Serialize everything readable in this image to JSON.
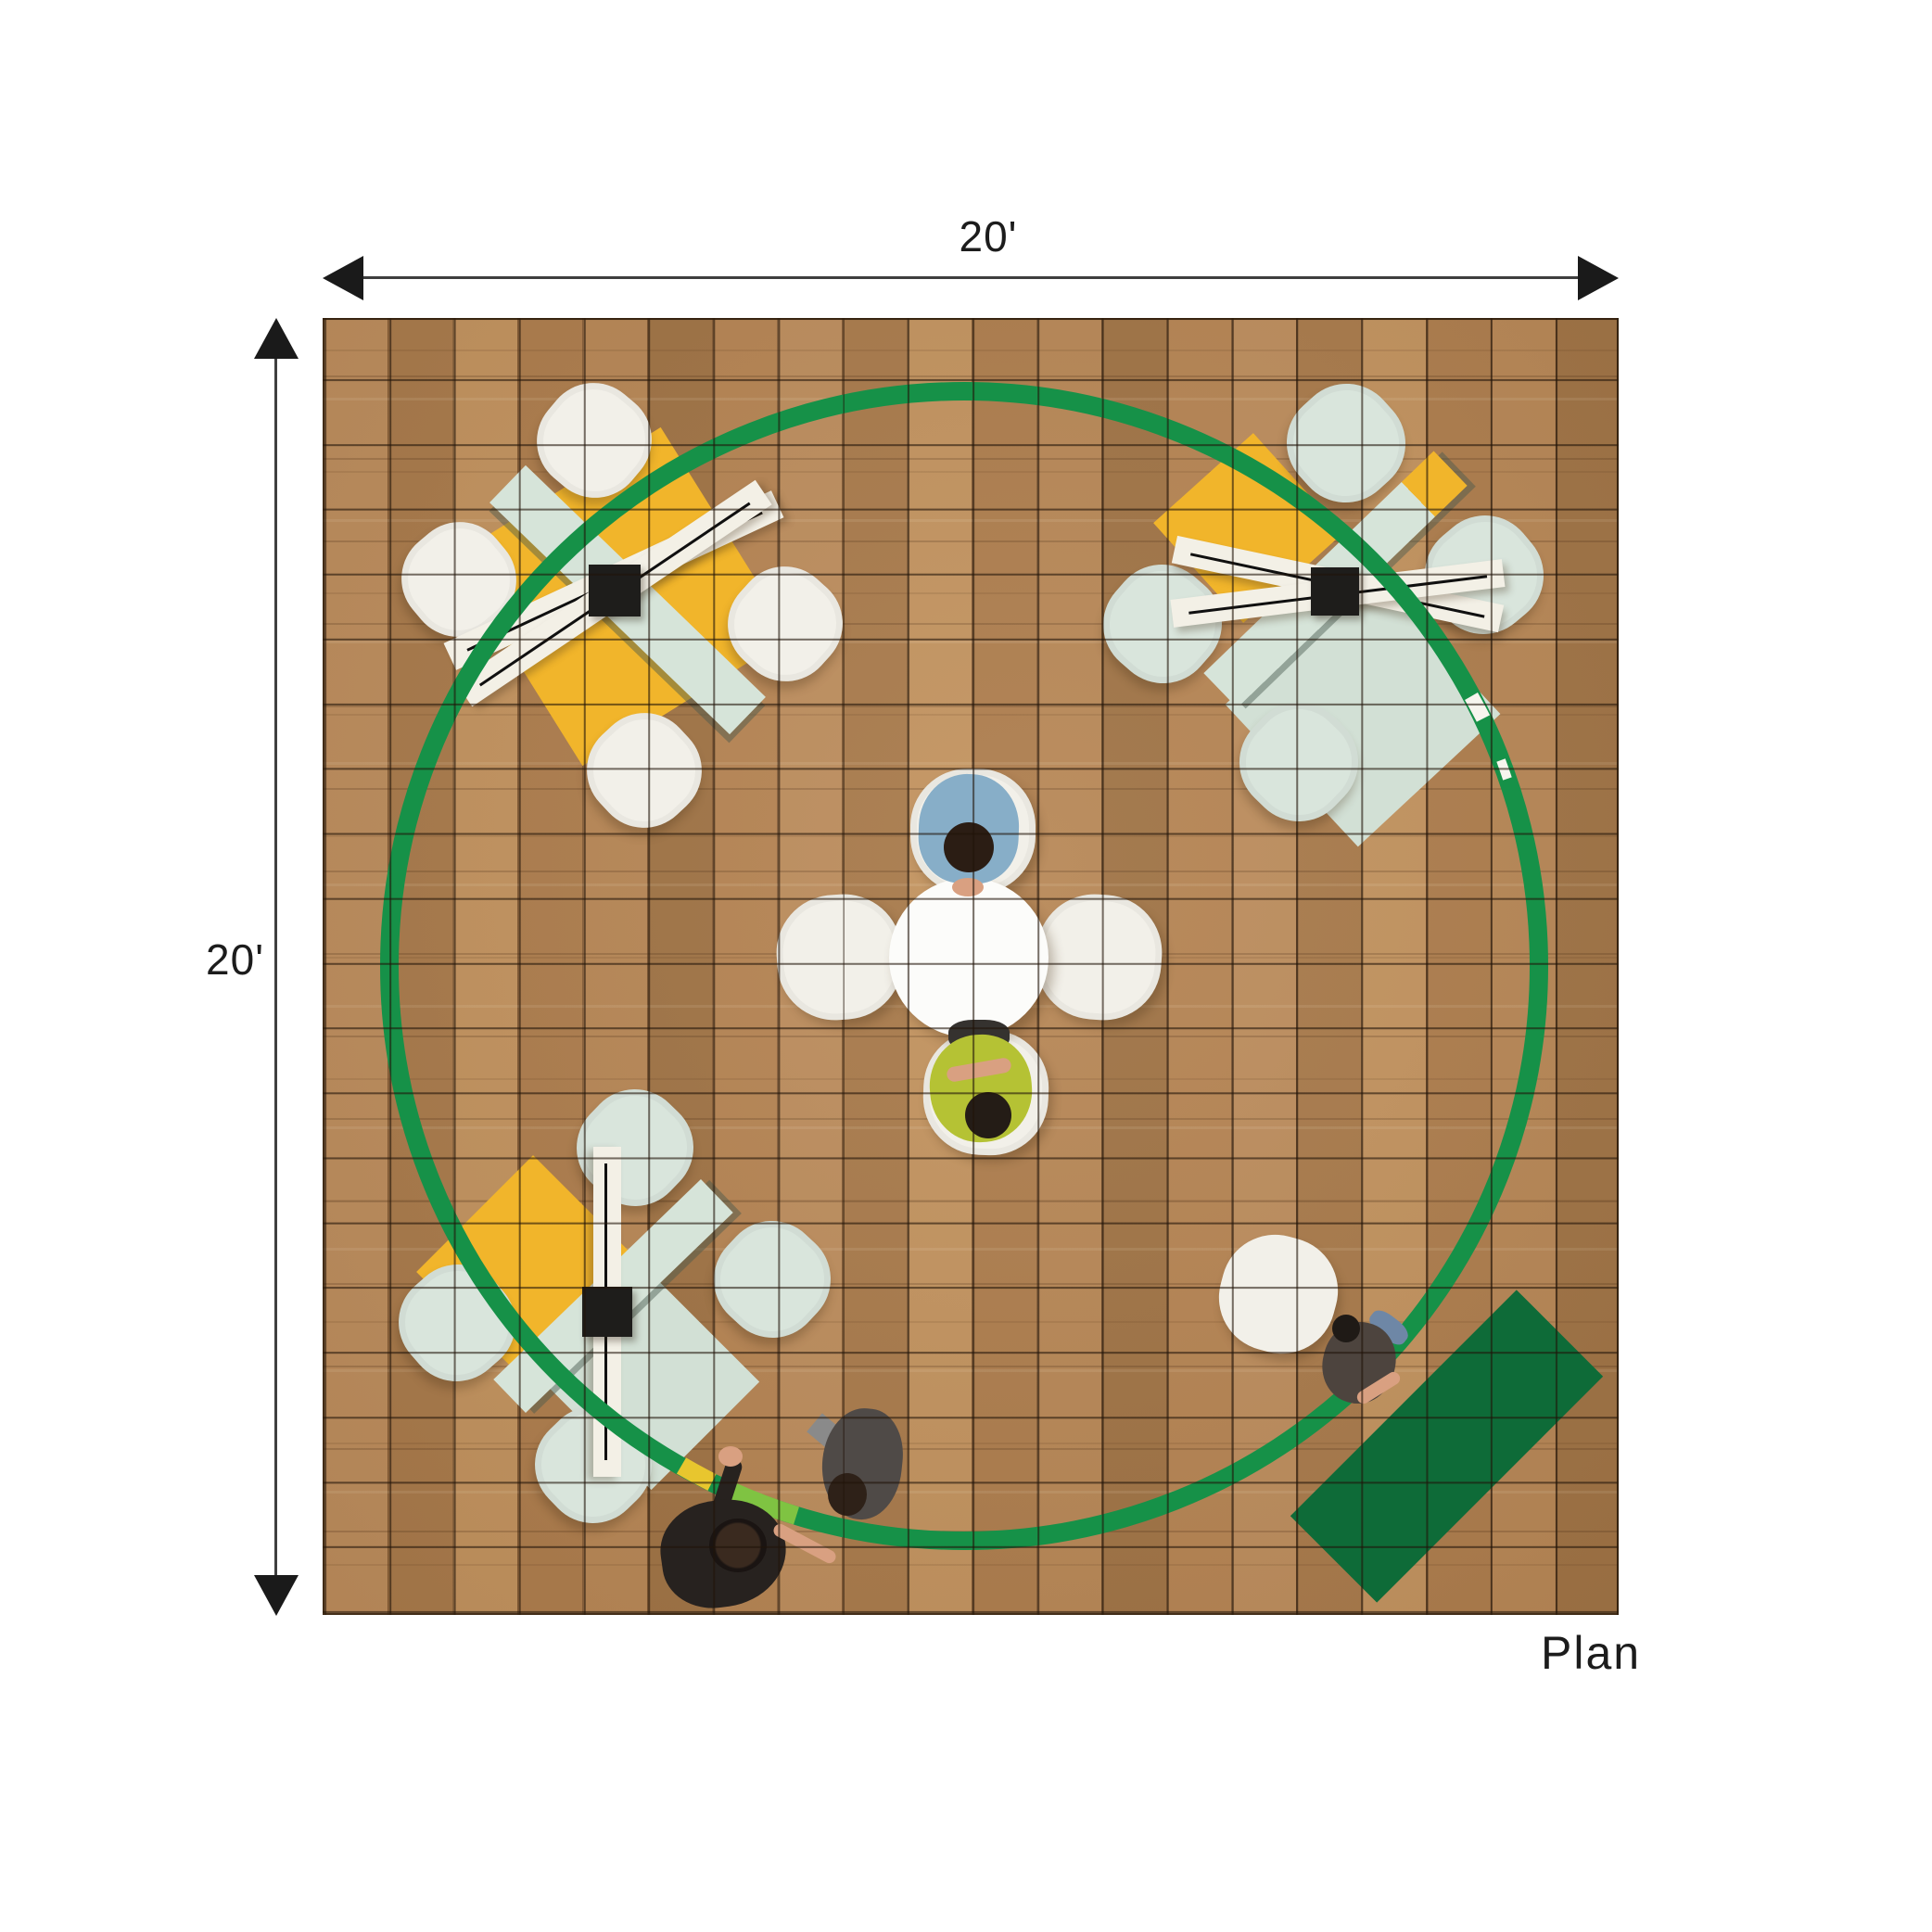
{
  "labels": {
    "width_dimension": "20'",
    "height_dimension": "20'",
    "caption": "Plan"
  },
  "colors": {
    "dim_text": "#1c1c1c",
    "dim_line": "#3f3f3f",
    "arrow_black": "#1a1a1a",
    "floor_base": "#b28253",
    "rug_yellow": "#f1b52b",
    "rug_mint": "#d2e0d5",
    "mint_bar": "#d6e4d9",
    "bar_white": "#f3f0e6",
    "table_black": "#1e1d1b",
    "chair_white": "#f2f0e9",
    "chair_mint": "#d9e5dc",
    "table_white": "#fcfcfa",
    "rug_green": "#0e6b38",
    "circle_green": "#169148",
    "circle_lime": "#7fc342",
    "circle_yellow": "#e8c62e",
    "person_blue": "#87aec8",
    "person_lime": "#b5c234",
    "person_black": "#27221f",
    "person_gray": "#4f4a47",
    "person_brown": "#4d443e",
    "jeans_blue": "#6e87a6",
    "skin": "#d9a081"
  }
}
